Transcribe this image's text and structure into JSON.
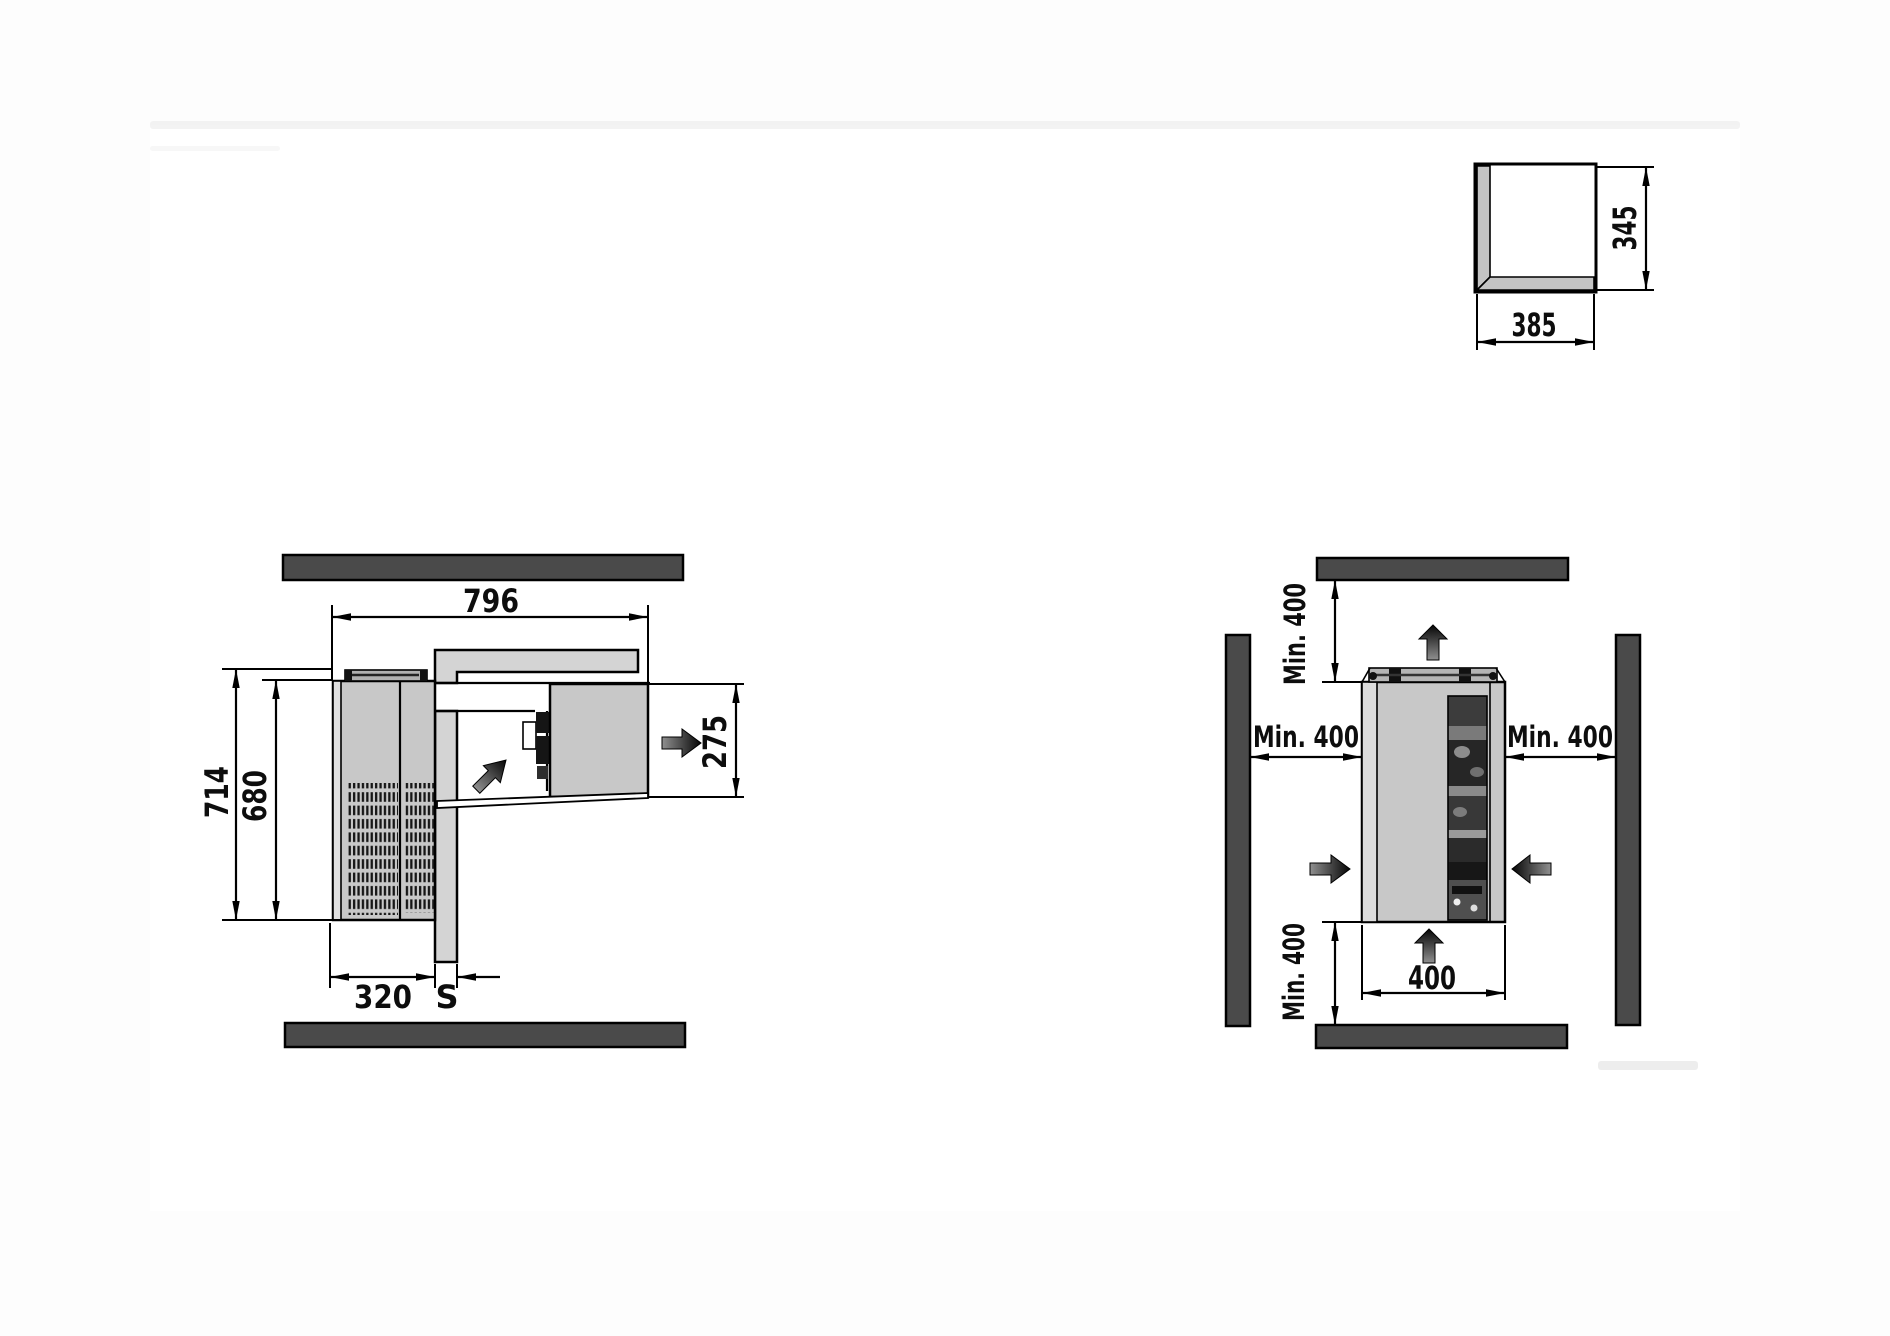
{
  "left_view": {
    "width": "796",
    "depth_total": "714",
    "depth_body": "680",
    "grille_width": "320",
    "wall_thickness": "S",
    "plug_depth": "275"
  },
  "right_view": {
    "clearance_top": "Min. 400",
    "clearance_left": "Min. 400",
    "clearance_right": "Min. 400",
    "clearance_bottom": "Min. 400",
    "unit_width": "400"
  },
  "cutout_detail": {
    "width": "385",
    "height": "345"
  },
  "colors": {
    "wall_dark": "#4a4a4a",
    "unit_gray": "#c8c8c8",
    "panel_gray": "#d4d4d4",
    "line": "#000000",
    "page": "#ffffff"
  }
}
